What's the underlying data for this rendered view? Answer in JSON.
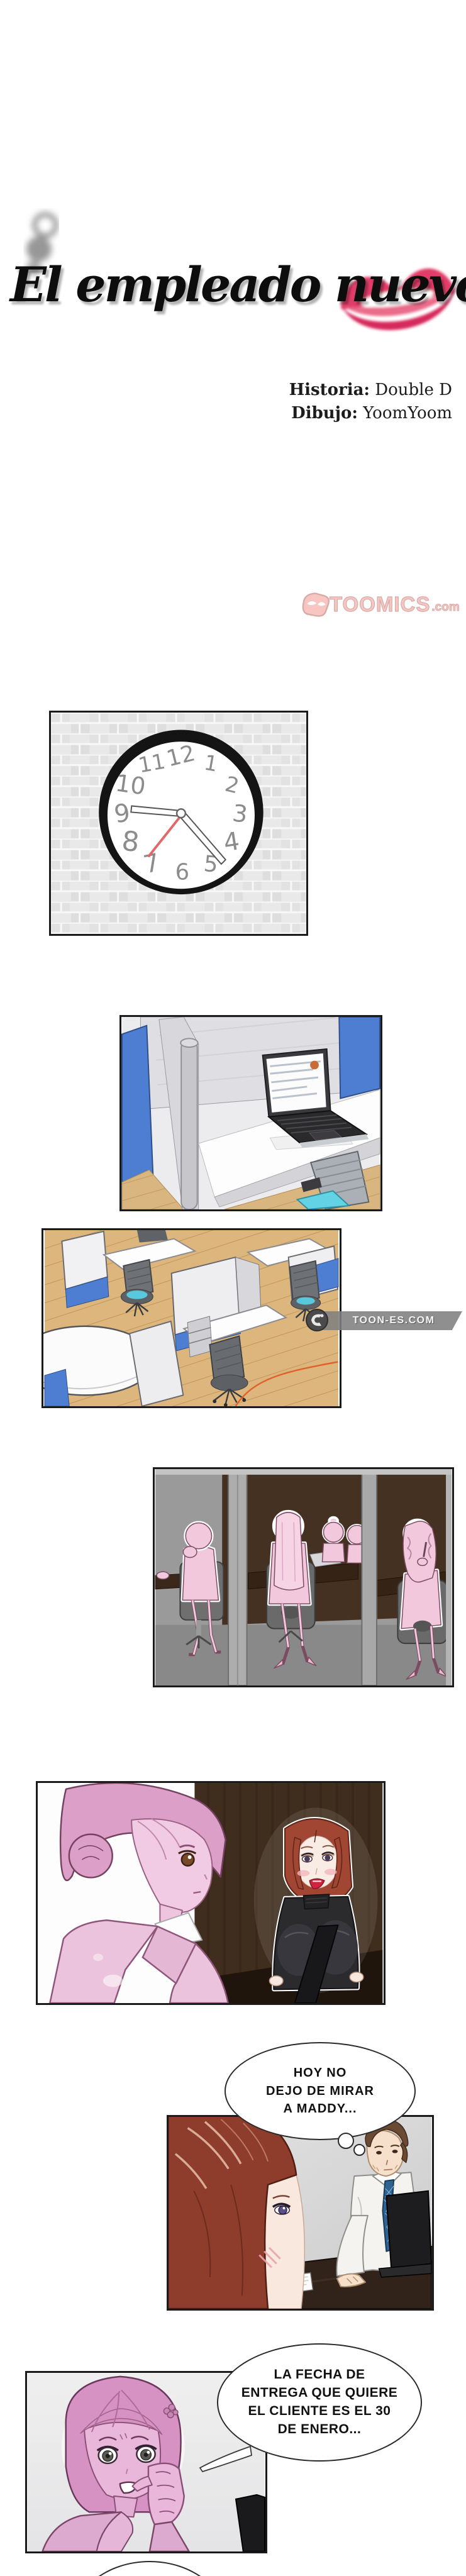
{
  "title": {
    "text": "El empleado nuevo"
  },
  "credits": {
    "story_label": "Historia:",
    "story_value": " Double D",
    "art_label": "Dibujo:",
    "art_value": " YoomYoom"
  },
  "logo": {
    "brand": "TOOMICS",
    "tld": ".com",
    "color": "#f2a7a2"
  },
  "watermark": {
    "text": "TOON-ES.COM",
    "color": "#8a8a8a"
  },
  "clock": {
    "numbers": [
      "12",
      "1",
      "2",
      "3",
      "4",
      "5",
      "6",
      "7",
      "8",
      "9",
      "10",
      "11"
    ]
  },
  "bubbles": {
    "thought_maddy": {
      "type": "thought",
      "text": "HOY NO\nDEJO DE MIRAR\nA MADDY..."
    },
    "speech_deadline": {
      "type": "speech",
      "text": "LA FECHA DE\nENTREGA QUE QUIERE\nEL CLIENTE ES EL 30\nDE ENERO..."
    }
  },
  "colors": {
    "kiss_red": "#dd2e5c",
    "panel_border": "#1a1a1a",
    "office_blue": "#4d7ed2",
    "wood_floor": "#d9b67f",
    "pink_character": "#e9b7da",
    "meeting_pink": "#f2c8dc",
    "hair_red": "#9e4434"
  }
}
